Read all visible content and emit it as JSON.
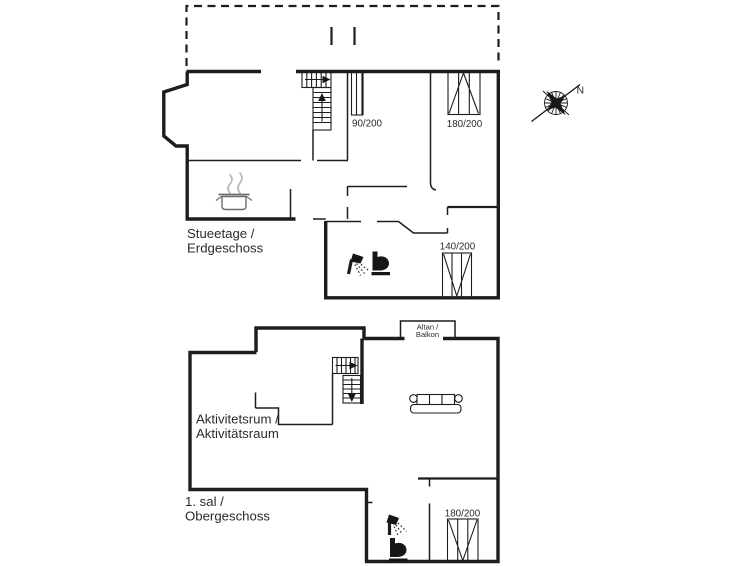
{
  "colors": {
    "background": "#ffffff",
    "wall_line": "#1d1d1b",
    "text": "#2b2b2b",
    "steam_gray": "#b8b8b8"
  },
  "ground_floor": {
    "label": {
      "line1": "Stueetage /",
      "line2": "Erdgeschoss"
    },
    "windows": {
      "hall": "90/200",
      "bedroom_top": "180/200",
      "bedroom_bottom": "140/200"
    }
  },
  "first_floor": {
    "label": {
      "line1": "1. sal /",
      "line2": "Obergeschoss"
    },
    "room_label": {
      "line1": "Aktivitetsrum /",
      "line2": "Aktivitätsraum"
    },
    "balcony": {
      "line1": "Altan /",
      "line2": "Balkon"
    },
    "windows": {
      "bathroom_side": "180/200"
    }
  },
  "compass": {
    "north": "N"
  },
  "icons": {
    "compass": "compass-rose-icon",
    "stove": "cooking-pot-icon",
    "shower": "shower-icon",
    "toilet": "toilet-icon",
    "sofa": "sofa-icon",
    "stairs": "staircase-icon"
  }
}
